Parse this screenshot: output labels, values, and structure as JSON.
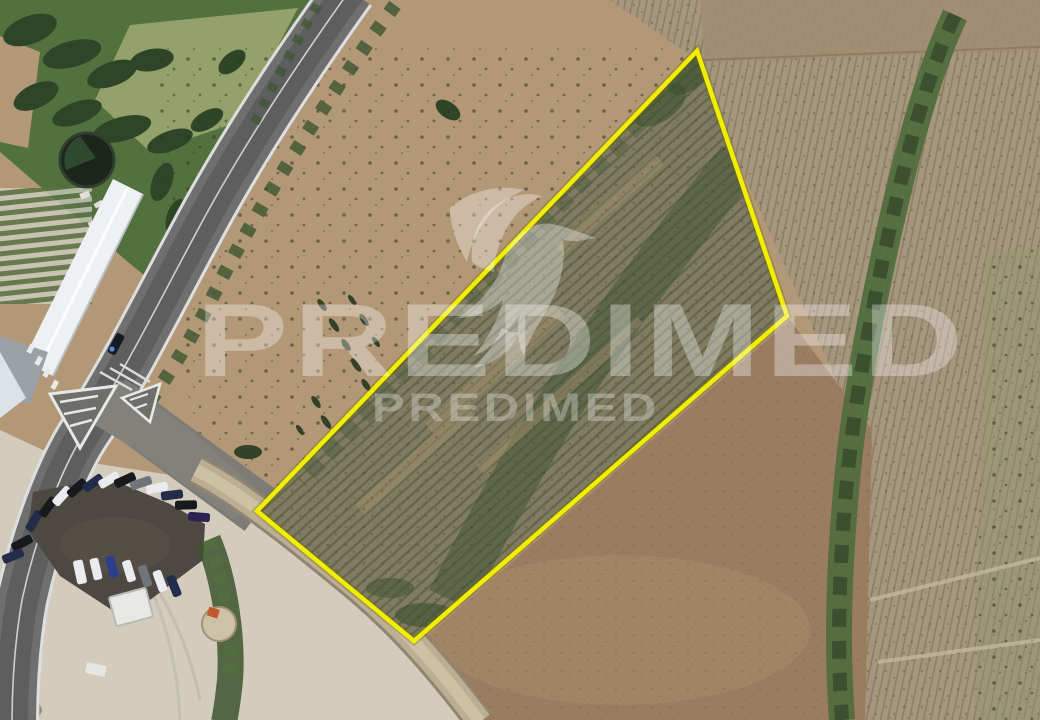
{
  "image": {
    "width": 1040,
    "height": 720,
    "description": "Aerial satellite photograph of agricultural land parcels beside a rural road, with a highlighted plot for sale"
  },
  "watermark": {
    "brand_large": "PREDIMED",
    "brand_small": "PREDIMED",
    "logo": "hummingbird",
    "color_rgba": "rgba(255,255,255,0.33)",
    "color_rgba_small": "rgba(255,255,255,0.30)"
  },
  "parcel": {
    "points_str": "697,51 787,316 414,641 257,511",
    "boundary_color": "#f2ee00",
    "halo_color": "rgba(110,105,0,0.35)",
    "stroke_width": "4.5"
  },
  "scene": {
    "palette": {
      "field_tan": "#b39878",
      "field_right": "#a6967e",
      "field_brown": "#9a7d61",
      "vegetation_dark": "#3c5530",
      "vegetation_bright": "#53703f",
      "asphalt": "#6f6f6f",
      "dirt_road": "#bcae93",
      "sand": "#d3ccbc",
      "parking_lot": "#4d4841",
      "building_roof": "#eef1f3"
    },
    "features": [
      "asphalt-road",
      "dirt-track",
      "parking-lot-with-cars",
      "warehouse-roof",
      "water-tank",
      "greenhouse-rows",
      "tree-lines",
      "plowed-fields",
      "round-hut",
      "shed"
    ]
  }
}
